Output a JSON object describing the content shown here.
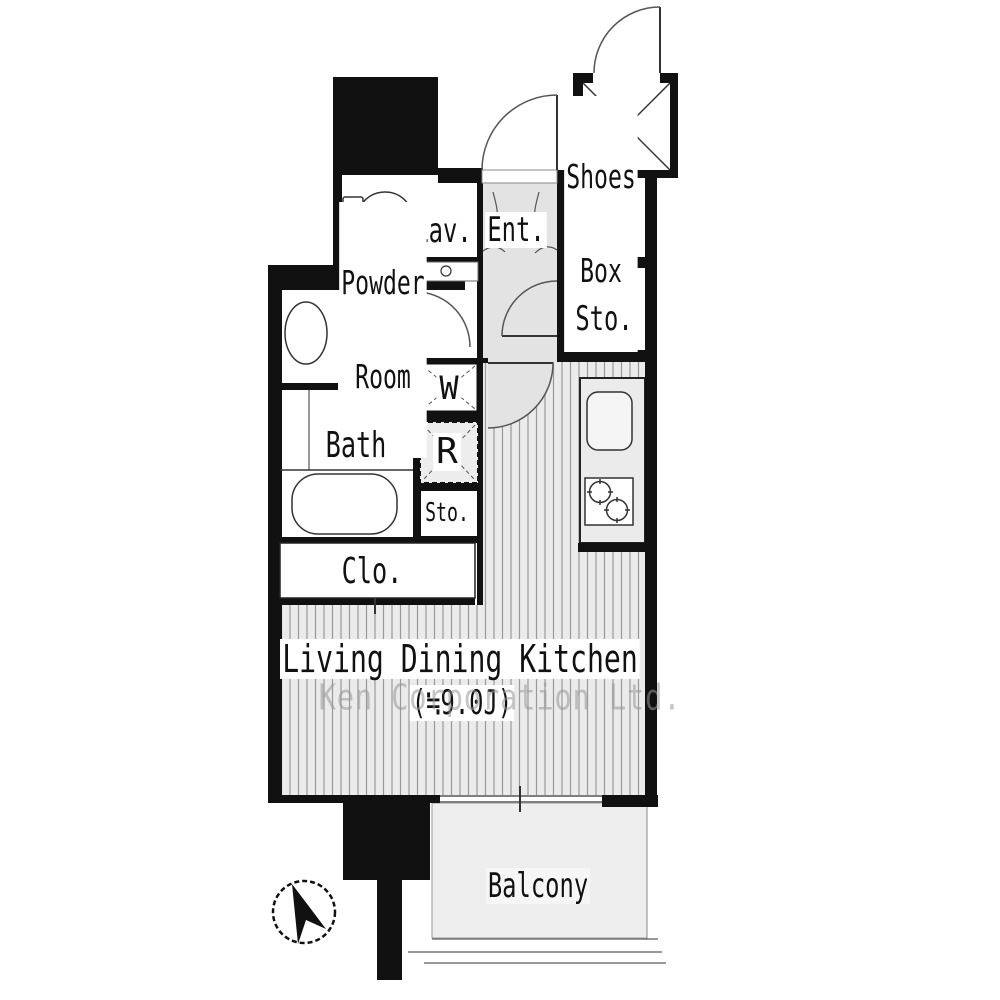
{
  "rooms": {
    "lav": {
      "label": "Lav."
    },
    "ent": {
      "label": "Ent."
    },
    "shoes_box": {
      "line1": "Shoes",
      "line2": "Box"
    },
    "sto_upper": {
      "label": "Sto."
    },
    "powder": {
      "line1": "Powder",
      "line2": "Room"
    },
    "bath": {
      "label": "Bath"
    },
    "washer": {
      "label": "W"
    },
    "fridge": {
      "label": "R"
    },
    "sto_small": {
      "label": "Sto."
    },
    "closet": {
      "label": "Clo."
    },
    "ldk": {
      "label": "Living Dining Kitchen",
      "area": "(≒9.0J)"
    },
    "balcony": {
      "label": "Balcony"
    }
  },
  "watermark": "Ken Corporation Ltd.",
  "compass": {
    "direction": "north"
  },
  "colors": {
    "wall": "#111111",
    "floor_stripe_line": "#9a9a9a",
    "floor_stripe_bg": "#ebebeb",
    "corridor_gray": "#e3e3e3",
    "balcony_gray": "#eeeeee",
    "watermark_gray": "#969696"
  }
}
